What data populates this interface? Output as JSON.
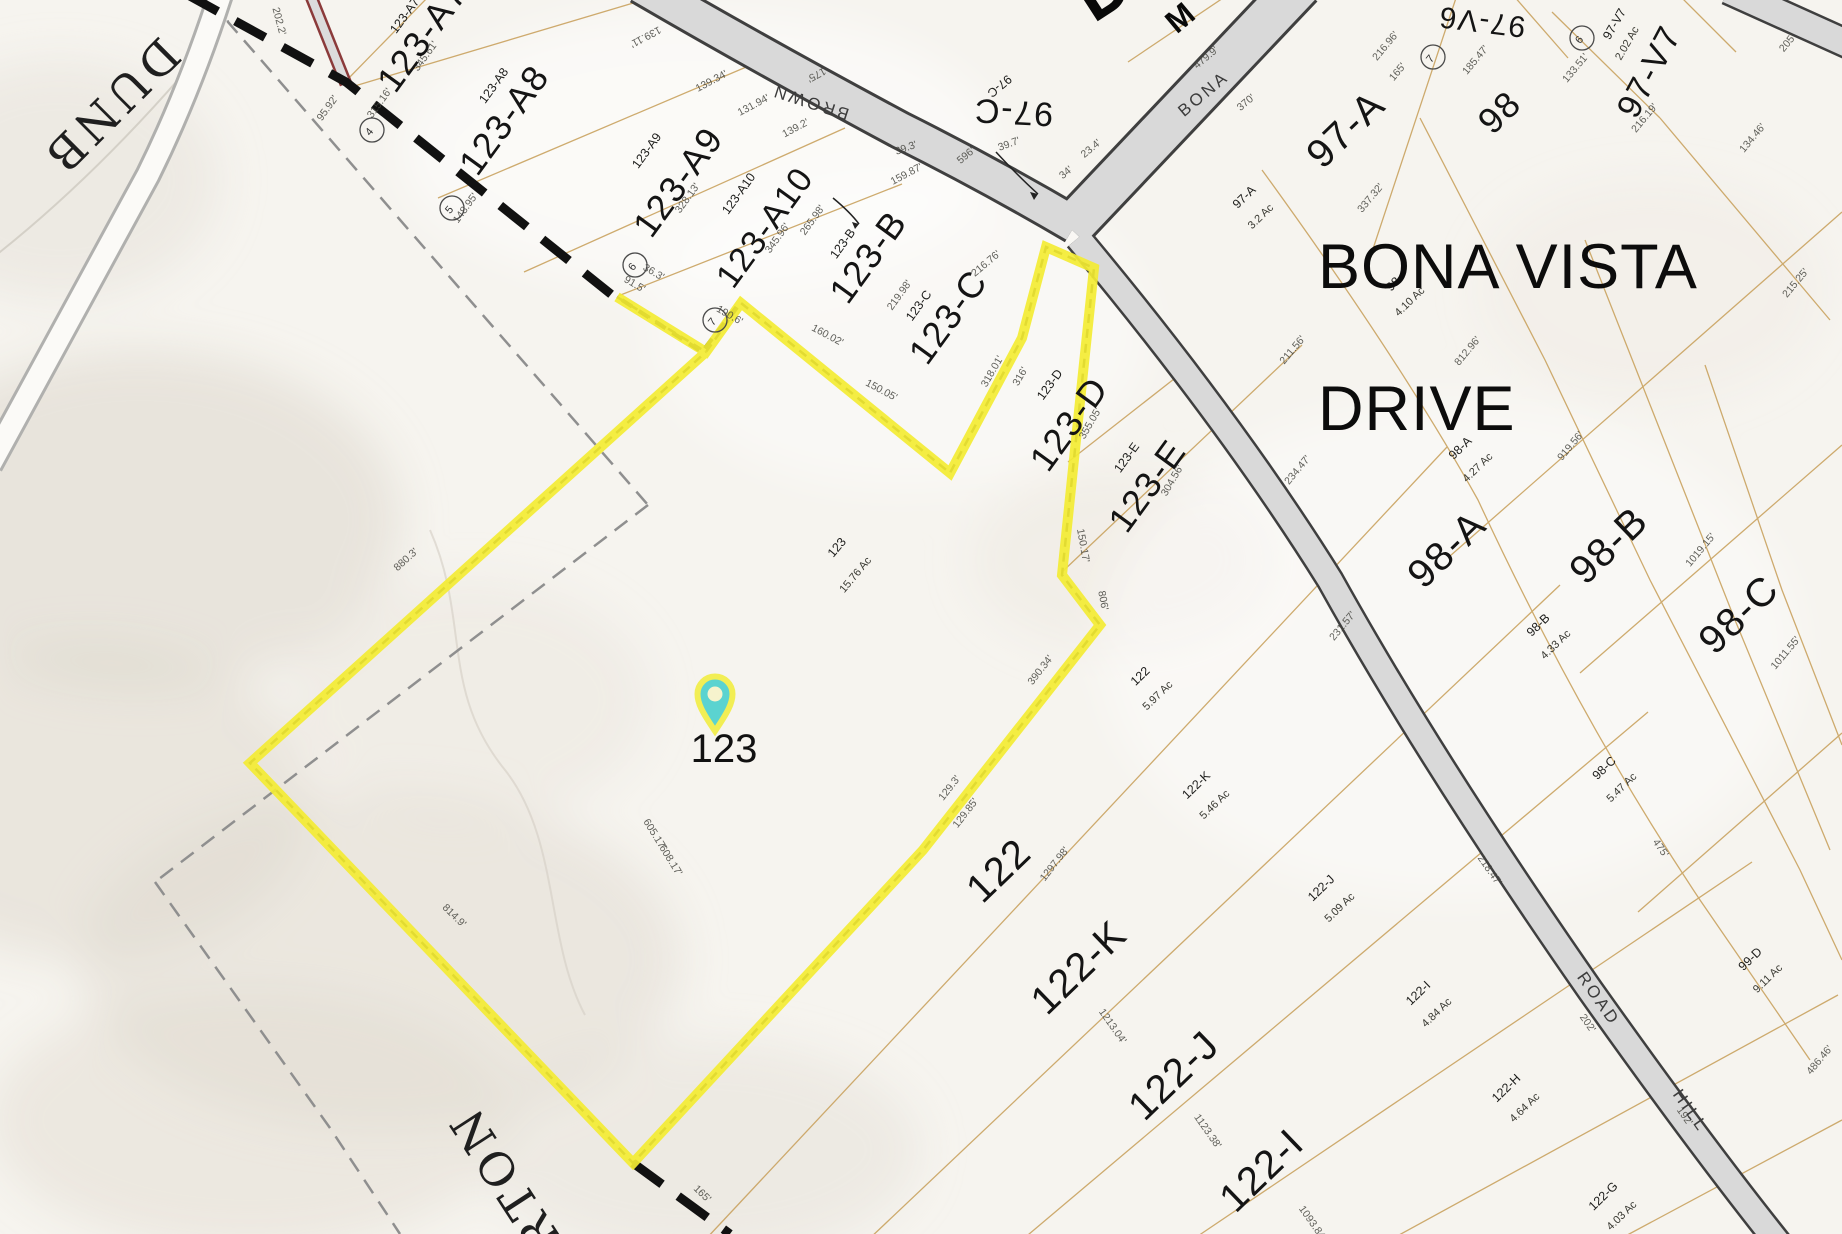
{
  "map": {
    "colors": {
      "highlight_yellow": "#f3ec33",
      "pin_teal": "#5bd3d0",
      "road_fill": "#d9d9d9",
      "road_edge": "#3f3f3f",
      "lot_line_tan": "#c9a25f",
      "boundary_dash": "#111111",
      "background": "#f6f4ef"
    },
    "big_street_label": {
      "line1": "BONA VISTA",
      "line2": "DRIVE"
    },
    "pin": {
      "label": "123"
    },
    "selected_parcel": {
      "id": "123",
      "acreage": "15.76 Ac"
    },
    "road_names": {
      "brown": "BROWN",
      "bona": "BONA",
      "road_upper": "ROAD",
      "hill": "HILL",
      "serif_top_fragment": "DUNB",
      "serif_bottom_fragment": "ARTON"
    },
    "fragments": {
      "big_d": "D",
      "m": "M"
    },
    "parcel_labels": [
      {
        "id": "123-A7",
        "sx": 408,
        "sy": 18,
        "sr": -54,
        "lx": 432,
        "ly": 44,
        "lr": -54,
        "ls": 36
      },
      {
        "id": "123-A8",
        "sx": 497,
        "sy": 88,
        "sr": -54,
        "lx": 514,
        "ly": 127,
        "lr": -54,
        "ls": 36
      },
      {
        "id": "123-A9",
        "sx": 650,
        "sy": 153,
        "sr": -54,
        "lx": 688,
        "ly": 189,
        "lr": -54,
        "ls": 36
      },
      {
        "id": "123-A10",
        "sx": 742,
        "sy": 196,
        "sr": -54,
        "lx": 774,
        "ly": 234,
        "lr": -54,
        "ls": 34
      },
      {
        "id": "123-B",
        "sx": 846,
        "sy": 246,
        "sr": -54,
        "lx": 878,
        "ly": 264,
        "lr": -54,
        "ls": 36
      },
      {
        "id": "123-C",
        "sx": 922,
        "sy": 308,
        "sr": -54,
        "lx": 958,
        "ly": 324,
        "lr": -54,
        "ls": 36
      },
      {
        "id": "123-D",
        "sx": 1053,
        "sy": 387,
        "sr": -54,
        "lx": 1079,
        "ly": 431,
        "lr": -54,
        "ls": 36
      },
      {
        "id": "123-E",
        "sx": 1130,
        "sy": 460,
        "sr": -54,
        "lx": 1157,
        "ly": 493,
        "lr": -54,
        "ls": 36
      },
      {
        "id": "123",
        "sx": 840,
        "sy": 550,
        "sr": -50,
        "ac": "15.76 Ac",
        "ax": 858,
        "ay": 577,
        "ar": -50
      },
      {
        "id": "97-C",
        "sx": 997,
        "sy": 83,
        "sr": 140,
        "lx": 1014,
        "ly": 101,
        "lr": 183,
        "ls": 34
      },
      {
        "id": "97-A",
        "sx": 1247,
        "sy": 200,
        "sr": -44,
        "ac": "3.2 Ac",
        "ax": 1263,
        "ay": 219,
        "lx": 1355,
        "ly": 139,
        "lr": -44,
        "ls": 40
      },
      {
        "id": "97-V6",
        "lx": 1483,
        "ly": 12,
        "lr": 187,
        "ls": 30
      },
      {
        "id": "97-V7",
        "sx": 1618,
        "sy": 26,
        "sr": -60,
        "ac": "2.02 Ac",
        "ax": 1630,
        "ay": 45,
        "ar": -60,
        "lx": 1659,
        "ly": 77,
        "lr": -62,
        "ls": 34
      },
      {
        "id": "98",
        "sx": 1396,
        "sy": 287,
        "sr": -44,
        "ac": "4.10 Ac",
        "ax": 1412,
        "ay": 304,
        "lx": 1508,
        "ly": 121,
        "lr": -44,
        "ls": 36
      },
      {
        "id": "98-A",
        "sx": 1463,
        "sy": 451,
        "sr": -44,
        "ac": "4.27 Ac",
        "ax": 1480,
        "ay": 470,
        "lx": 1456,
        "ly": 559,
        "lr": -44,
        "ls": 40
      },
      {
        "id": "98-B",
        "sx": 1541,
        "sy": 628,
        "sr": -44,
        "ac": "4.33 Ac",
        "ax": 1558,
        "ay": 647,
        "lx": 1618,
        "ly": 555,
        "lr": -44,
        "ls": 40
      },
      {
        "id": "98-C",
        "sx": 1607,
        "sy": 771,
        "sr": -44,
        "ac": "5.47 Ac",
        "ax": 1624,
        "ay": 790,
        "lx": 1748,
        "ly": 624,
        "lr": -44,
        "ls": 40
      },
      {
        "id": "99-D",
        "sx": 1753,
        "sy": 962,
        "sr": -44,
        "ac": "9.11 Ac",
        "ax": 1770,
        "ay": 981
      },
      {
        "id": "122",
        "sx": 1143,
        "sy": 679,
        "sr": -44,
        "ac": "5.97 Ac",
        "ax": 1160,
        "ay": 698,
        "lx": 1008,
        "ly": 880,
        "lr": -44,
        "ls": 40
      },
      {
        "id": "122-K",
        "sx": 1199,
        "sy": 788,
        "sr": -44,
        "ac": "5.46 Ac",
        "ax": 1217,
        "ay": 807,
        "lx": 1088,
        "ly": 977,
        "lr": -44,
        "ls": 40
      },
      {
        "id": "122-J",
        "sx": 1324,
        "sy": 891,
        "sr": -44,
        "ac": "5.09 Ac",
        "ax": 1342,
        "ay": 910,
        "lx": 1183,
        "ly": 1085,
        "lr": -44,
        "ls": 40
      },
      {
        "id": "122-I",
        "sx": 1421,
        "sy": 996,
        "sr": -44,
        "ac": "4.84 Ac",
        "ax": 1439,
        "ay": 1015,
        "lx": 1271,
        "ly": 1180,
        "lr": -44,
        "ls": 40
      },
      {
        "id": "122-H",
        "sx": 1509,
        "sy": 1091,
        "sr": -44,
        "ac": "4.64 Ac",
        "ax": 1527,
        "ay": 1110
      },
      {
        "id": "122-G",
        "sx": 1606,
        "sy": 1199,
        "sr": -44,
        "ac": "4.03 Ac",
        "ax": 1624,
        "ay": 1218
      }
    ],
    "circled_numbers": [
      {
        "n": "4",
        "x": 372,
        "y": 130
      },
      {
        "n": "5",
        "x": 452,
        "y": 208
      },
      {
        "n": "6",
        "x": 635,
        "y": 265
      },
      {
        "n": "7",
        "x": 715,
        "y": 320
      },
      {
        "n": "7",
        "x": 1433,
        "y": 57
      },
      {
        "n": "6",
        "x": 1582,
        "y": 38
      }
    ],
    "dimension_labels": [
      [
        "95.92'",
        330,
        110,
        -54
      ],
      [
        "202.2'",
        276,
        22,
        75
      ],
      [
        "345.61'",
        428,
        58,
        -54
      ],
      [
        "315.16'",
        382,
        105,
        -54
      ],
      [
        "148.95'",
        468,
        210,
        -54
      ],
      [
        "328.13'",
        690,
        200,
        -54
      ],
      [
        "345.96'",
        780,
        240,
        -54
      ],
      [
        "265.98'",
        815,
        222,
        -54
      ],
      [
        "219.98'",
        902,
        297,
        -54
      ],
      [
        "318.01'",
        995,
        373,
        -60
      ],
      [
        "316'",
        1023,
        378,
        -60
      ],
      [
        "355.05'",
        1093,
        425,
        -60
      ],
      [
        "304.56'",
        1175,
        482,
        -60
      ],
      [
        "150.05'",
        880,
        393,
        28
      ],
      [
        "160.02'",
        826,
        338,
        28
      ],
      [
        "150.17'",
        1080,
        546,
        80
      ],
      [
        "806'",
        1100,
        601,
        80
      ],
      [
        "36.3'",
        652,
        275,
        30
      ],
      [
        "91.5'",
        633,
        287,
        30
      ],
      [
        "190.6'",
        728,
        318,
        30
      ],
      [
        "139.11'",
        644,
        34,
        152
      ],
      [
        "175'",
        815,
        72,
        152
      ],
      [
        "139.34'",
        713,
        84,
        -28
      ],
      [
        "131.94'",
        755,
        108,
        -28
      ],
      [
        "139.2'",
        797,
        131,
        -28
      ],
      [
        "159.87'",
        908,
        177,
        -28
      ],
      [
        "596'",
        968,
        158,
        -40
      ],
      [
        "39.3'",
        907,
        151,
        -20
      ],
      [
        "39.7'",
        1010,
        147,
        -20
      ],
      [
        "34'",
        1068,
        175,
        -40
      ],
      [
        "23.4'",
        1093,
        151,
        -40
      ],
      [
        "216.76'",
        988,
        266,
        -40
      ],
      [
        "479.9'",
        1208,
        60,
        -40
      ],
      [
        "370'",
        1248,
        105,
        -40
      ],
      [
        "216.96'",
        1388,
        48,
        -50
      ],
      [
        "165'",
        1400,
        74,
        -50
      ],
      [
        "185.47'",
        1478,
        62,
        -50
      ],
      [
        "133.51'",
        1578,
        70,
        -50
      ],
      [
        "216.19'",
        1647,
        120,
        -50
      ],
      [
        "134.46'",
        1755,
        140,
        -50
      ],
      [
        "205'",
        1790,
        45,
        -50
      ],
      [
        "215.25'",
        1798,
        285,
        -50
      ],
      [
        "337.32'",
        1373,
        200,
        -50
      ],
      [
        "812.96'",
        1470,
        353,
        -50
      ],
      [
        "211.56'",
        1295,
        352,
        -50
      ],
      [
        "234.47'",
        1300,
        472,
        -50
      ],
      [
        "231.57'",
        1345,
        628,
        -50
      ],
      [
        "919.56'",
        1573,
        448,
        -50
      ],
      [
        "1019.15'",
        1703,
        552,
        -50
      ],
      [
        "1011.55'",
        1788,
        655,
        -50
      ],
      [
        "475'",
        1658,
        850,
        55
      ],
      [
        "486.46'",
        1822,
        1062,
        -50
      ],
      [
        "390.34'",
        1043,
        672,
        -52
      ],
      [
        "129.3'",
        952,
        790,
        -52
      ],
      [
        "129.85'",
        968,
        815,
        -52
      ],
      [
        "1297.98'",
        1057,
        866,
        -52
      ],
      [
        "605.17'",
        652,
        836,
        58
      ],
      [
        "608.17'",
        668,
        862,
        58
      ],
      [
        "880.3'",
        408,
        562,
        -42
      ],
      [
        "814.9'",
        452,
        918,
        44
      ],
      [
        "165'",
        700,
        1196,
        44
      ],
      [
        "218.47'",
        1487,
        872,
        55
      ],
      [
        "202'",
        1585,
        1025,
        55
      ],
      [
        "192'",
        1682,
        1118,
        55
      ],
      [
        "1123.38'",
        1205,
        1133,
        55
      ],
      [
        "1093.84'",
        1310,
        1225,
        55
      ],
      [
        "1213.04'",
        1110,
        1028,
        55
      ]
    ]
  }
}
